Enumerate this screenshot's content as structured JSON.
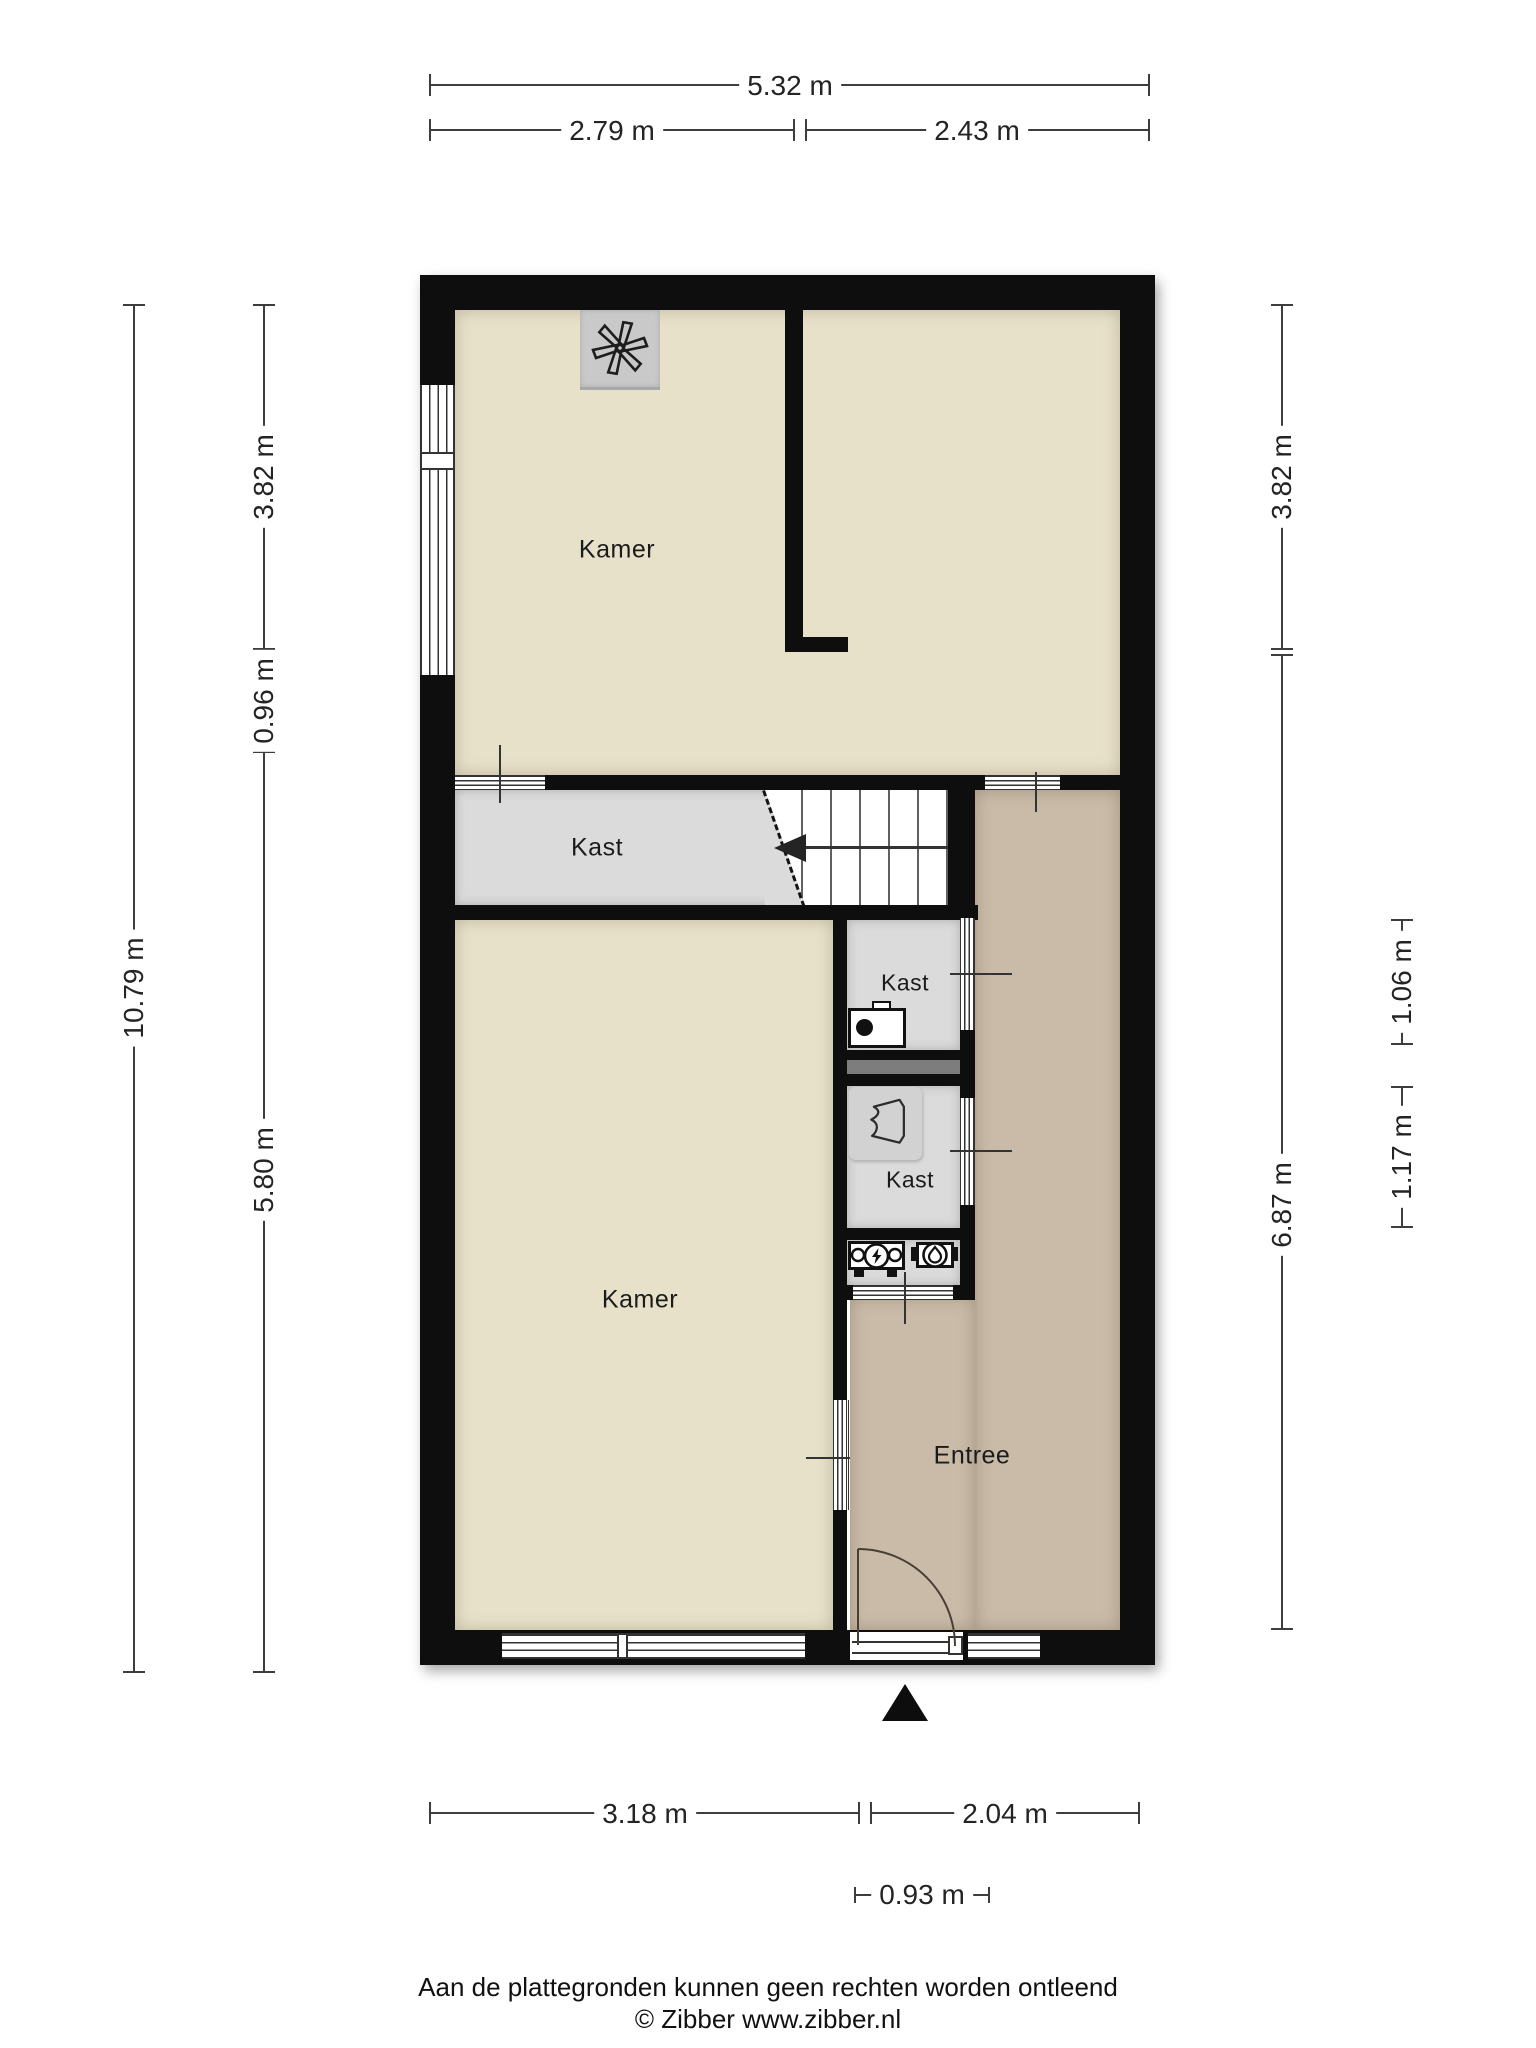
{
  "title": "Floor plan (plattegrond)",
  "rooms": {
    "kamer_top": "Kamer",
    "kast_stairs": "Kast",
    "kast_1": "Kast",
    "kast_2": "Kast",
    "kamer_bottom": "Kamer",
    "entree": "Entree"
  },
  "dims": {
    "w_total": "5.32 m",
    "w_left": "2.79 m",
    "w_right": "2.43 m",
    "h_total": "10.79 m",
    "h_top": "3.82 m",
    "h_mid": "0.96 m",
    "h_bottom": "5.80 m",
    "r_top": "3.82 m",
    "r_bottom": "6.87 m",
    "r_kast1": "1.06 m",
    "r_kast2": "1.17 m",
    "b_left": "3.18 m",
    "b_right": "2.04 m",
    "b_door": "0.93 m"
  },
  "icons": {
    "ventilation": "mechanical-ventilation-fan-icon",
    "boiler": "cv-boiler-icon",
    "wardrobe": "coat-closet-icon",
    "electric_meter": "electricity-meter-icon",
    "water_meter": "water-meter-icon",
    "entrance": "entrance-arrow-icon",
    "stairs": "staircase-up-arrow-icon"
  },
  "footer": {
    "disclaimer": "Aan de plattegronden kunnen geen rechten worden ontleend",
    "credit": "© Zibber www.zibber.nl"
  },
  "colors": {
    "wall": "#0e0e0e",
    "room_beige": "#e8e1ca",
    "room_gray": "#dbdbdb",
    "entree_brown": "#c9bba8",
    "shaft_gray": "#7d7d7d",
    "dim_line": "#3d3d3d"
  }
}
